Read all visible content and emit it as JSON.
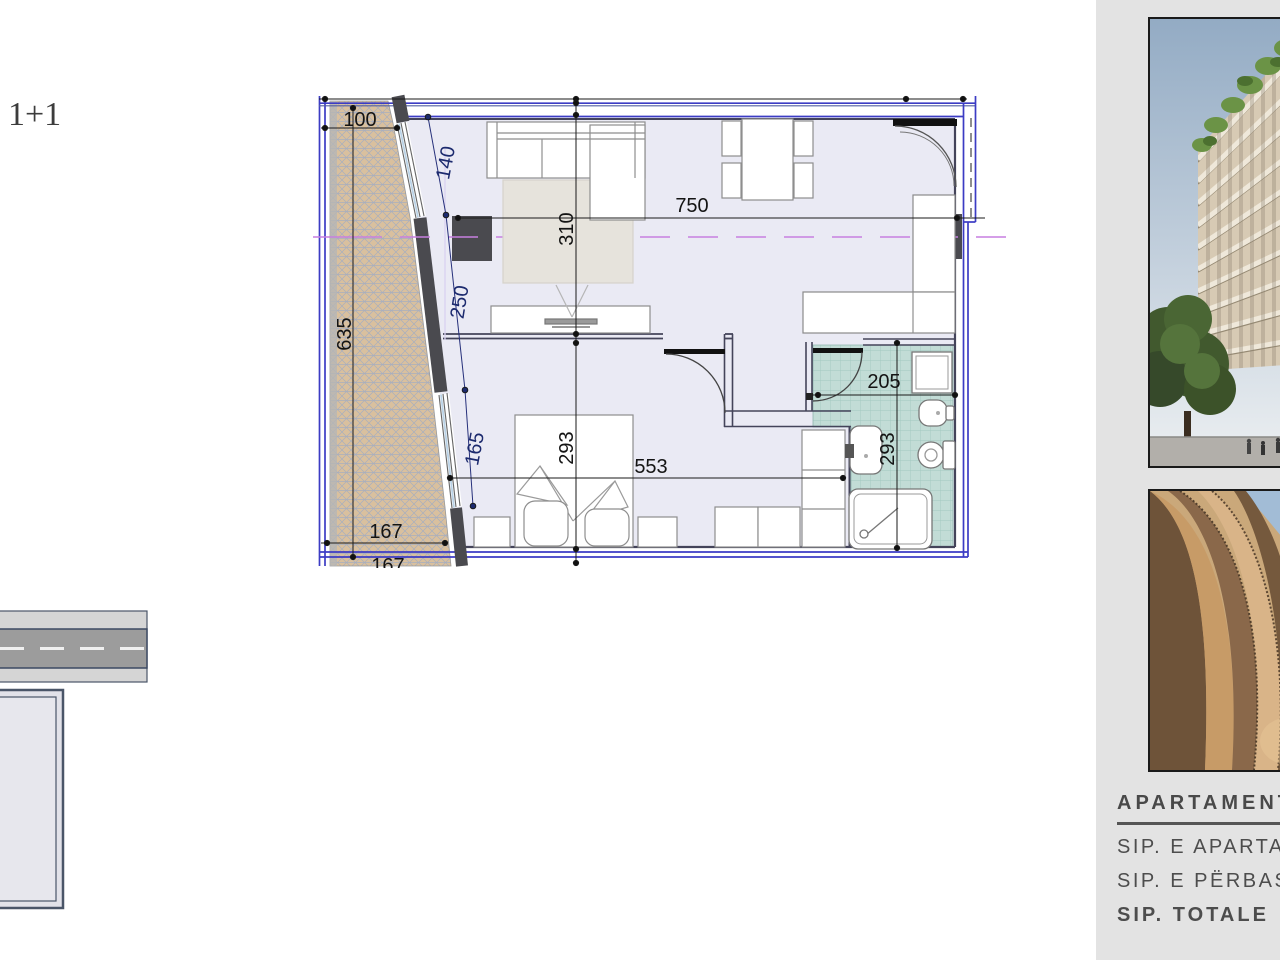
{
  "title": {
    "label": "1+1"
  },
  "floor_plan": {
    "dims": {
      "balcony_top_width": "100",
      "window_upper": "140",
      "living_width": "750",
      "living_depth": "310",
      "window_middle": "250",
      "balcony_length": "635",
      "window_lower": "165",
      "bedroom_depth": "293",
      "bedroom_width": "553",
      "balcony_bottom_width": "167",
      "balcony_bottom_width_2": "167",
      "bathroom_width": "205",
      "bathroom_depth": "293"
    },
    "rooms": [
      "living-dining",
      "bedroom",
      "bathroom",
      "balcony",
      "hall"
    ]
  },
  "sidebar": {
    "photo_top": "building-exterior-render",
    "photo_bottom": "facade-detail-render",
    "info_heading": "APARTAMENT",
    "area_apartment_label": "SIP. E APARTAM",
    "area_common_label": "SIP. E PËRBASH",
    "area_total_label": "SIP. TOTALE"
  },
  "colors": {
    "frame_blue": "#3c3cc4",
    "wall_dark": "#4a4a4f",
    "balcony_hatch_tan": "#d9c09e",
    "bathroom_teal": "#c2dcd6",
    "floor_lavender": "#eaeaf4",
    "section_magenta": "#c77fe0",
    "sidebar_bg": "#e3e3e3",
    "text_gray": "#4d4d4d"
  }
}
